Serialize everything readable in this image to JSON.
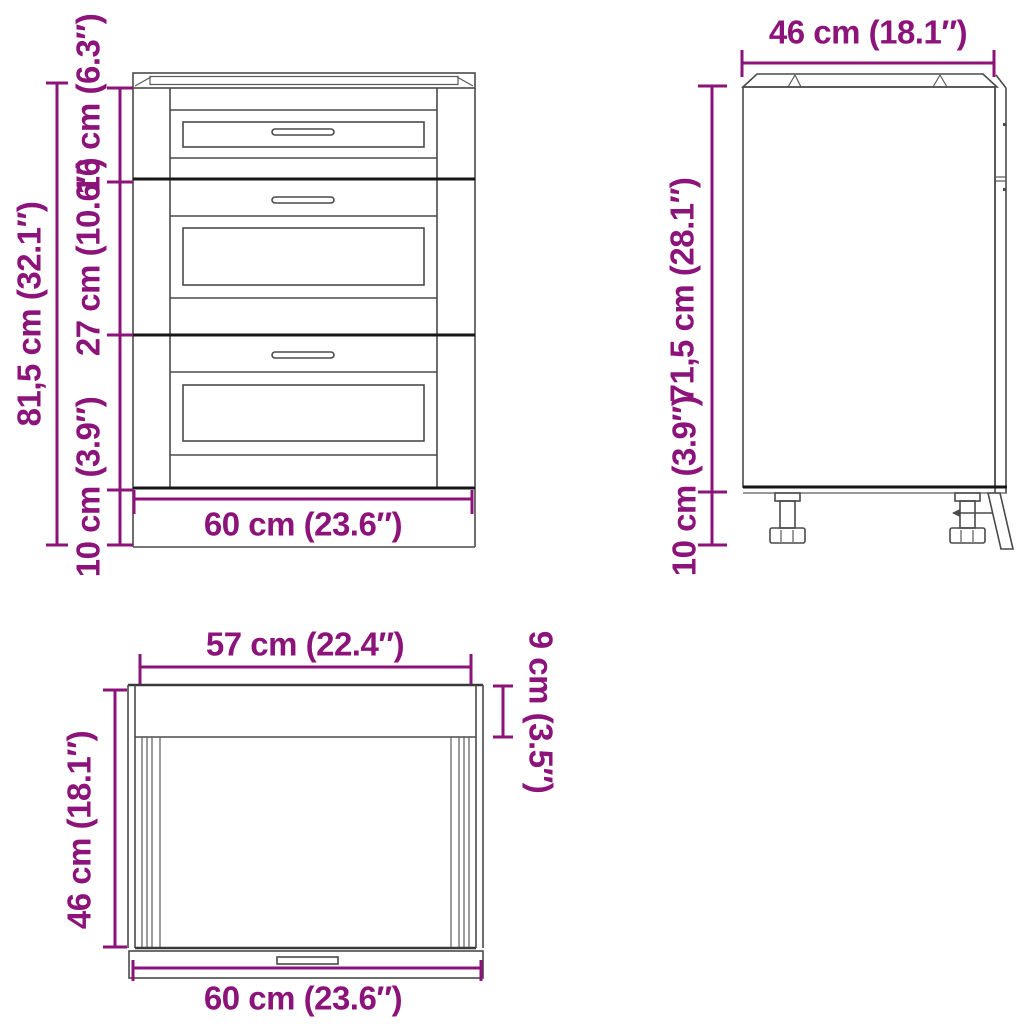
{
  "document": {
    "type": "furniture-dimension-diagram",
    "subject": "kitchen base cabinet with three drawers"
  },
  "colors": {
    "accent": "#8b1379",
    "line": "#4a4a4a",
    "line_dark": "#161616",
    "background": "#ffffff"
  },
  "views": {
    "front": {
      "name": "front-view",
      "dimensions": {
        "total_height": "81,5 cm (32.1″)",
        "top_drawer_height": "16 cm (6.3″)",
        "middle_drawer_height": "27 cm (10.6″)",
        "leg_height": "10 cm (3.9″)",
        "width": "60 cm (23.6″)"
      }
    },
    "side": {
      "name": "side-view",
      "dimensions": {
        "depth": "46 cm (18.1″)",
        "body_height": "71,5 cm (28.1″)",
        "leg_height": "10 cm (3.9″)"
      }
    },
    "top": {
      "name": "top-view",
      "dimensions": {
        "inner_width": "57 cm (22.4″)",
        "front_rail_depth": "9 cm (3.5″)",
        "depth": "46 cm (18.1″)",
        "width": "60 cm (23.6″)"
      }
    }
  }
}
